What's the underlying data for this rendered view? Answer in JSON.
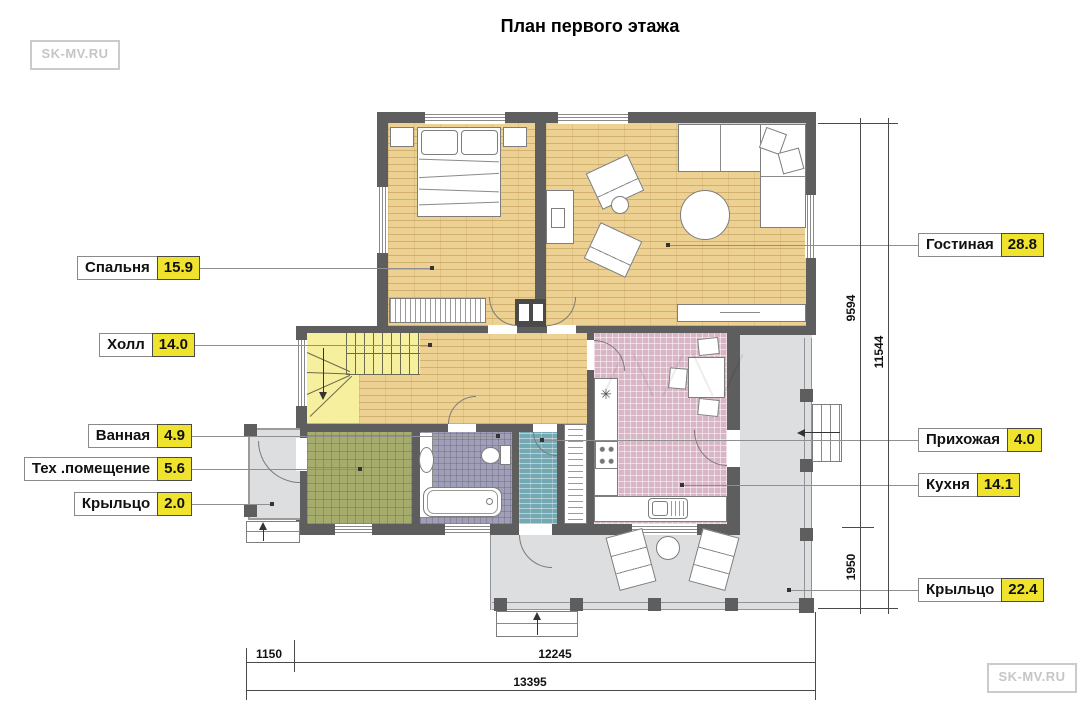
{
  "title": "План первого этажа",
  "watermark": {
    "top_left": "SK-MV.RU",
    "bottom_right": "SK-MV.RU"
  },
  "room_labels": {
    "bedroom": {
      "name": "Спальня",
      "area": "15.9"
    },
    "hall": {
      "name": "Холл",
      "area": "14.0"
    },
    "bathroom": {
      "name": "Ванная",
      "area": "4.9"
    },
    "tech_room": {
      "name": "Тех .помещение",
      "area": "5.6"
    },
    "porch_small": {
      "name": "Крыльцо",
      "area": "2.0"
    },
    "living_room": {
      "name": "Гостиная",
      "area": "28.8"
    },
    "entry_hall": {
      "name": "Прихожая",
      "area": "4.0"
    },
    "kitchen": {
      "name": "Кухня",
      "area": "14.1"
    },
    "porch_large": {
      "name": "Крыльцо",
      "area": "22.4"
    }
  },
  "dimensions_mm": {
    "right_upper": "9594",
    "right_total": "11544",
    "right_lower": "1950",
    "bottom_left": "1150",
    "bottom_main": "12245",
    "bottom_total": "13395"
  },
  "icons": {
    "fridge": "✳"
  },
  "colors": {
    "wall": "#5e5e5e",
    "wood_floor": "#ecd193",
    "stairs": "#f6ef9e",
    "tile_green": "#a6ad6c",
    "tile_purple": "#a19fb6",
    "tile_teal": "#74a9b3",
    "tile_pink": "#d9b6c6",
    "porch_gray": "#dcdee0",
    "area_highlight": "#efe32d"
  }
}
